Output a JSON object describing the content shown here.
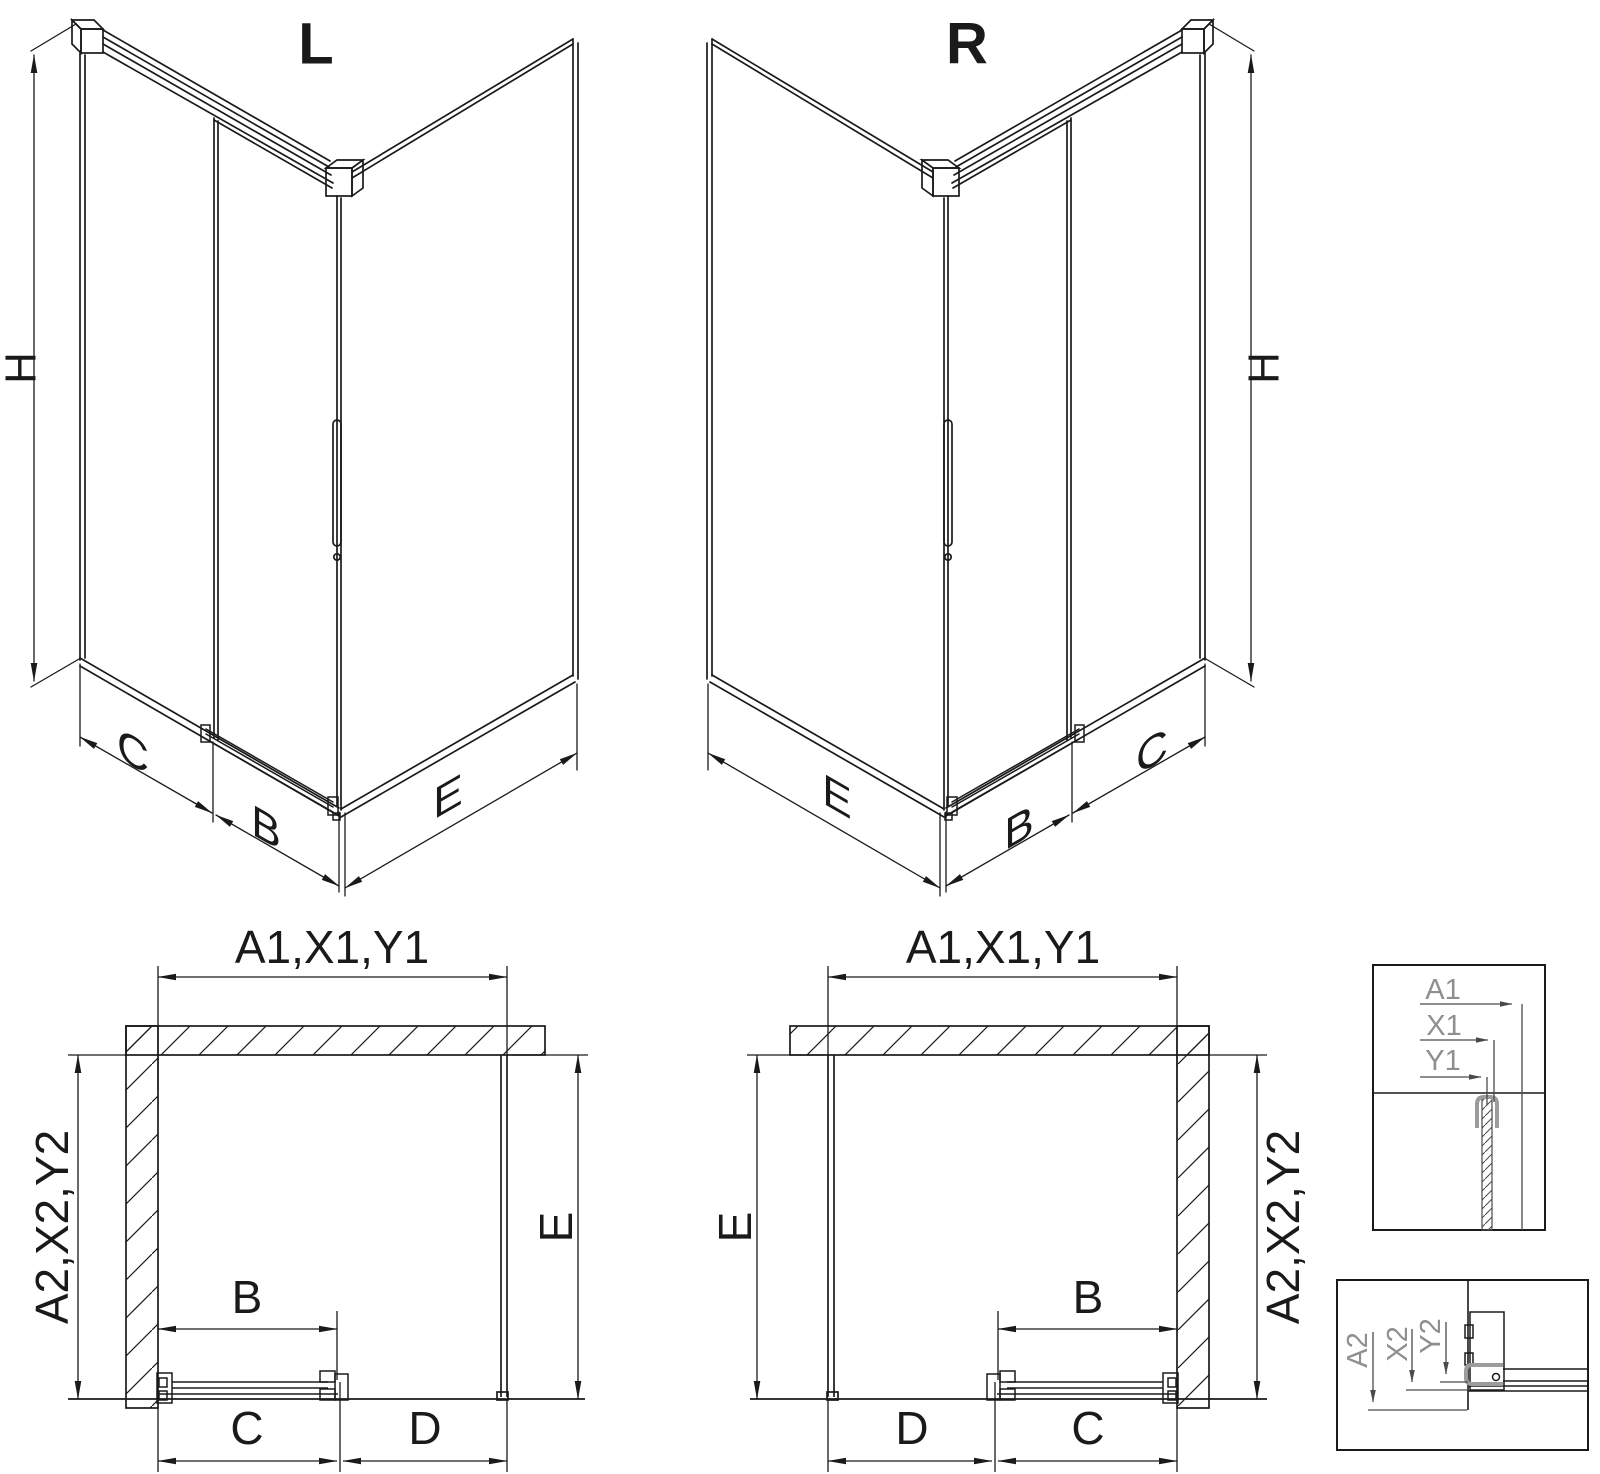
{
  "drawing": {
    "background": "#ffffff",
    "line_color": "#1a1a1a",
    "detail_line_color": "#4a4a4a",
    "detail_text_color": "#8f8f8f",
    "profile_gray": "#9c9c9c"
  },
  "iso_left": {
    "title": "L",
    "height_label": "H",
    "fixed_panel_label": "C",
    "door_panel_label": "B",
    "side_panel_label": "E"
  },
  "iso_right": {
    "title": "R",
    "height_label": "H",
    "fixed_panel_label": "C",
    "door_panel_label": "B",
    "side_panel_label": "E"
  },
  "plan_left": {
    "width_label": "A1,X1,Y1",
    "depth_label": "A2,X2,Y2",
    "side_label": "E",
    "door_label": "B",
    "bottom_inner_label": "C",
    "bottom_outer_label": "D"
  },
  "plan_right": {
    "width_label": "A1,X1,Y1",
    "depth_label": "A2,X2,Y2",
    "side_label": "E",
    "door_label": "B",
    "bottom_inner_label": "C",
    "bottom_outer_label": "D"
  },
  "detail_top": {
    "a1": "A1",
    "x1": "X1",
    "y1": "Y1"
  },
  "detail_bottom": {
    "a2": "A2",
    "x2": "X2",
    "y2": "Y2"
  }
}
